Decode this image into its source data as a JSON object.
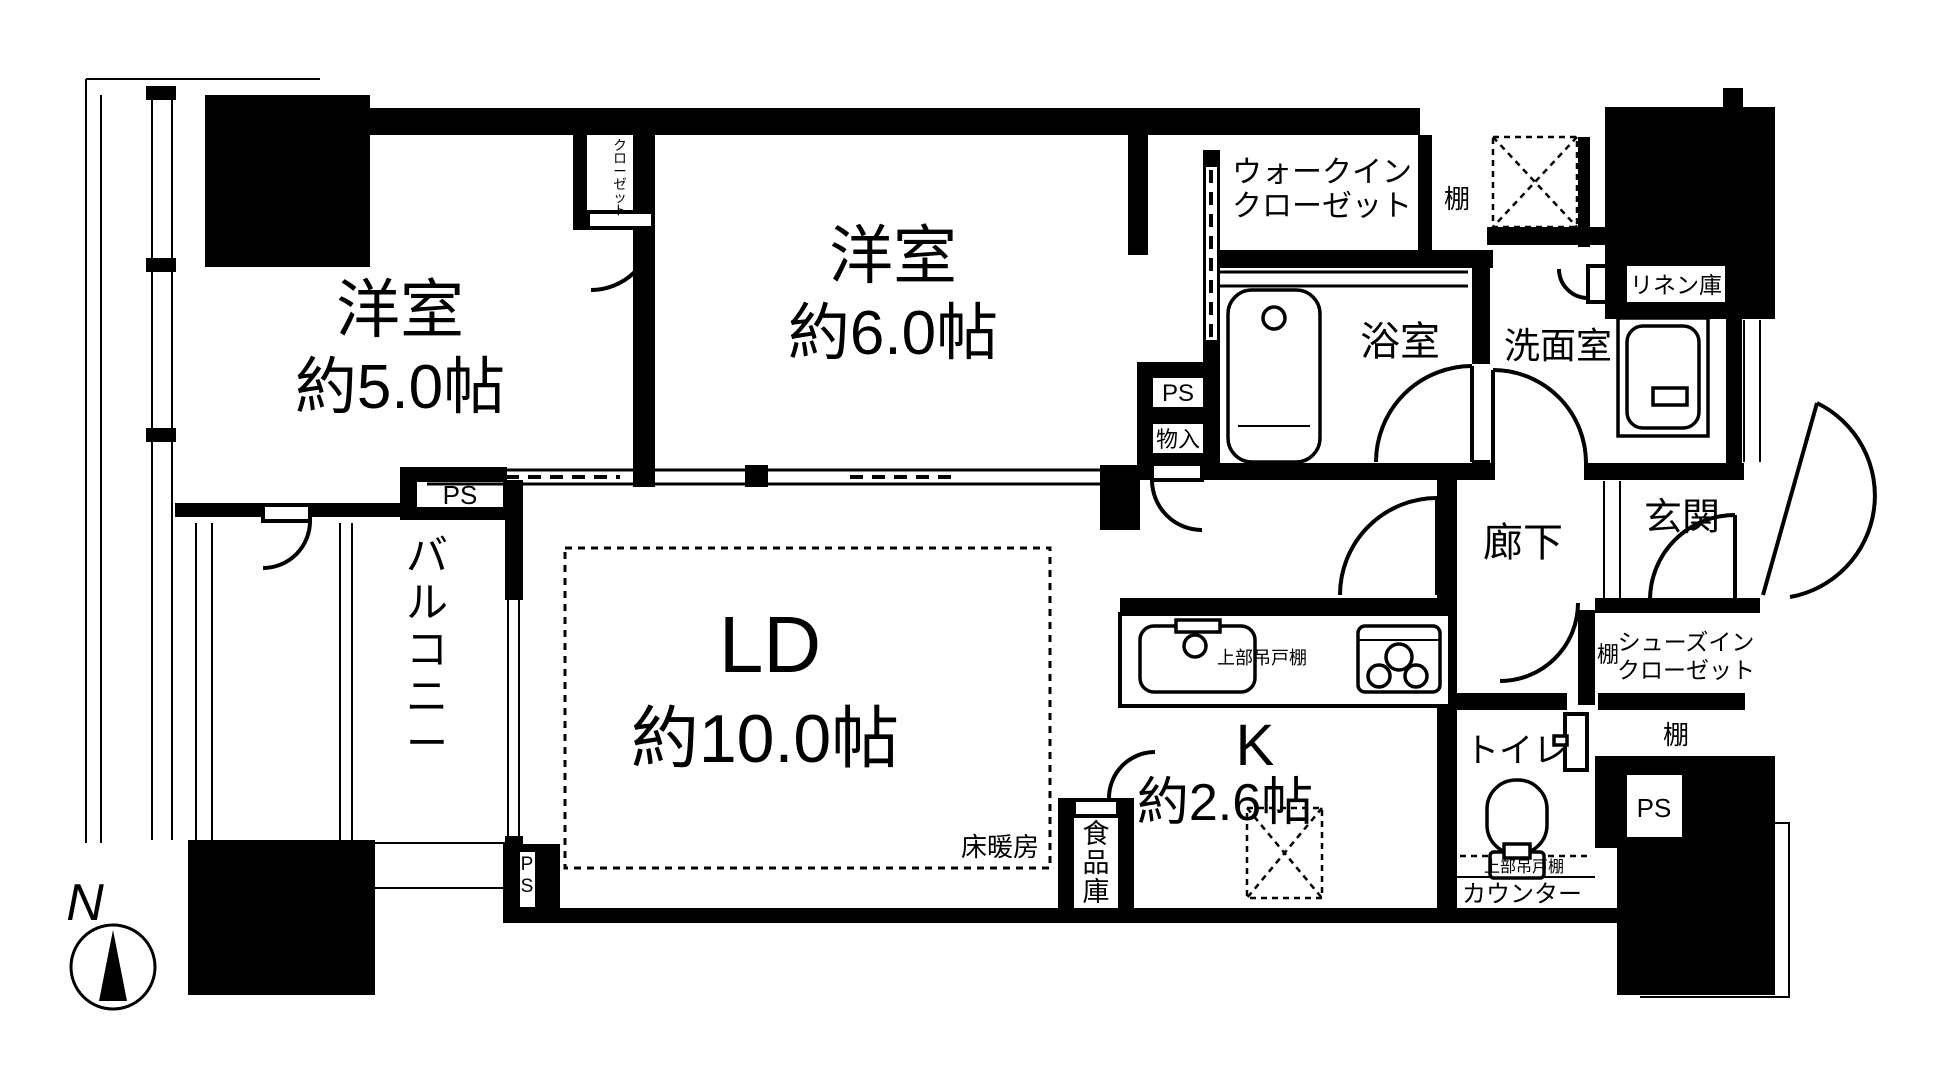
{
  "floorplan": {
    "compass": {
      "north_label": "N"
    },
    "rooms": {
      "bedroom1": {
        "name": "洋室",
        "size": "約5.0帖"
      },
      "bedroom2": {
        "name": "洋室",
        "size": "約6.0帖"
      },
      "living_dining": {
        "name": "LD",
        "size": "約10.0帖",
        "floor_heating": "床暖房"
      },
      "kitchen": {
        "name": "K",
        "size": "約2.6帖",
        "upper_cabinet": "上部吊戸棚",
        "pantry": "食品庫"
      },
      "bath": {
        "name": "浴室"
      },
      "washroom": {
        "name": "洗面室",
        "linen": "リネン庫"
      },
      "toilet": {
        "name": "トイレ",
        "upper_cabinet": "上部吊戸棚",
        "counter": "カウンター"
      },
      "hallway": {
        "name": "廊下"
      },
      "entrance": {
        "name": "玄関"
      },
      "walk_in_closet": {
        "line1": "ウォークイン",
        "line2": "クローゼット"
      },
      "shoes_in_closet": {
        "line1": "シューズイン",
        "line2": "クローゼット",
        "shelf": "棚"
      },
      "closet": {
        "name": "クローゼット"
      },
      "balcony": {
        "name": "バルコニー"
      },
      "shelf_top": {
        "name": "棚"
      },
      "shelf_bottom": {
        "name": "棚"
      }
    },
    "service": {
      "ps_top_left": "PS",
      "ps_mid": "PS",
      "storage_mid": "物入",
      "ps_balcony": "PS",
      "ps_bottom_right": "PS"
    }
  }
}
